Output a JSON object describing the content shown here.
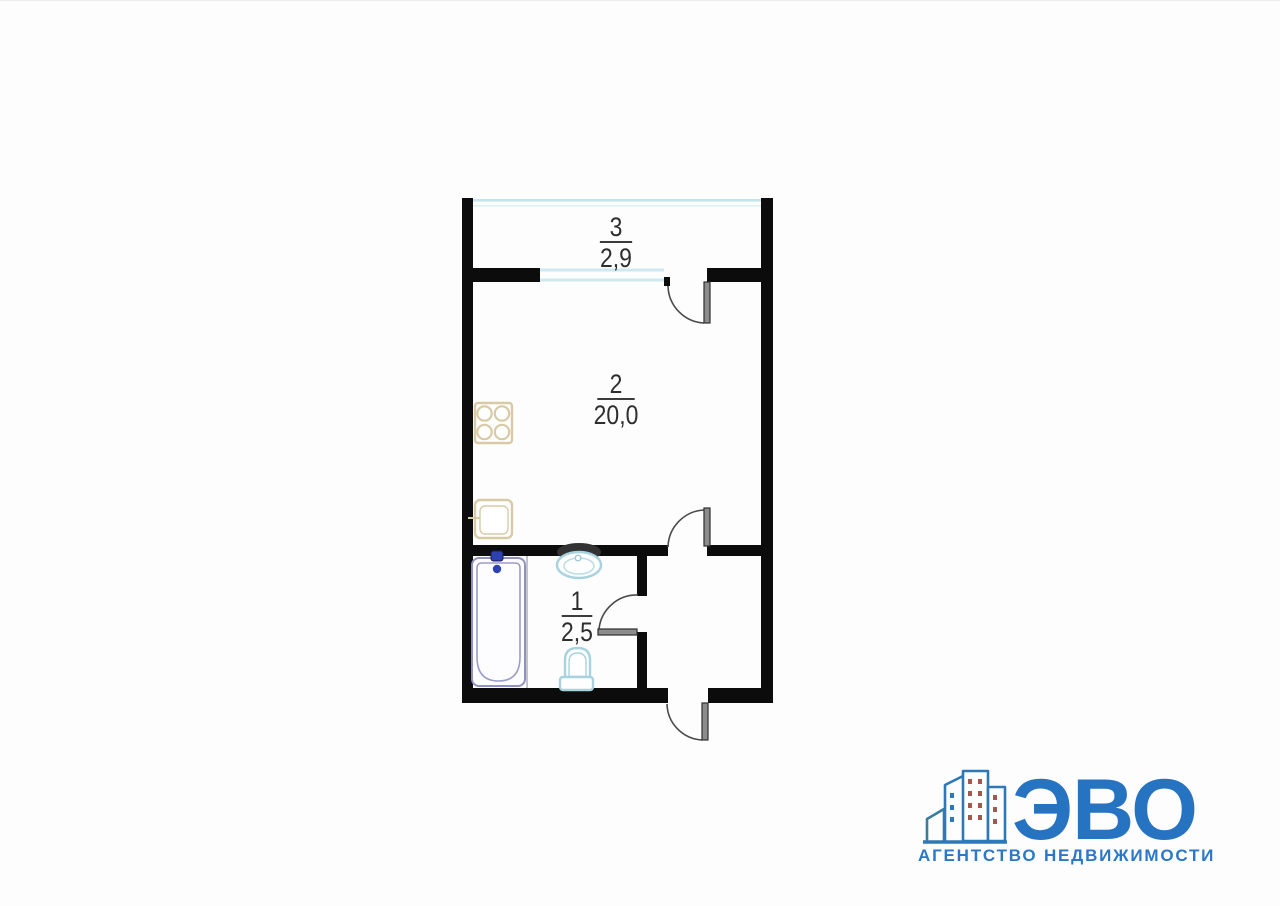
{
  "floor_plan": {
    "rooms": [
      {
        "number": "3",
        "area": "2,9"
      },
      {
        "number": "2",
        "area": "20,0"
      },
      {
        "number": "1",
        "area": "2,5"
      }
    ],
    "fixtures": [
      "stove-icon",
      "kitchen-sink-icon",
      "bathtub-icon",
      "bathtub-faucet-icon",
      "bath-sink-icon",
      "toilet-icon"
    ],
    "colors": {
      "wall": "#0c0c0c",
      "window_glass": "#c6e5eb",
      "sanitary_blue": "#a8d2de",
      "bathtub_outline": "#8f92c0",
      "kitchen_beige": "#d8caa4",
      "faucet_blue": "#2d42b0",
      "label_text": "#2e2e2e"
    }
  },
  "logo": {
    "brand": "ЭВО",
    "tagline": "АГЕНТСТВО НЕДВИЖИМОСТИ",
    "brand_color": "#2673c2",
    "icon": "buildings-icon"
  }
}
